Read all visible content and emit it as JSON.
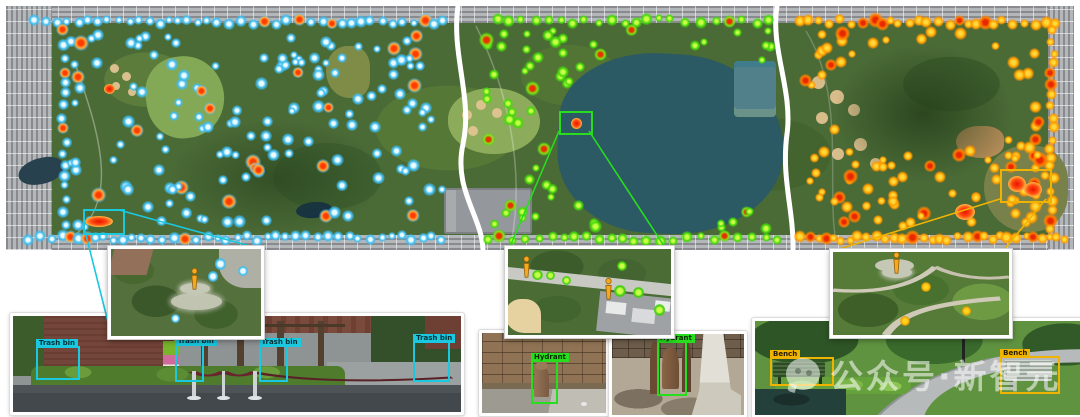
{
  "watermark": {
    "text": "公众号·新智元"
  },
  "object_classes": [
    {
      "name": "Trash bin",
      "color": "#1ac8e0"
    },
    {
      "name": "Hydrant",
      "color": "#28dd1e"
    },
    {
      "name": "Bench",
      "color": "#f0b400"
    }
  ],
  "heatmap": {
    "seed": 1337,
    "zones": [
      {
        "name": "trash-bin-zone",
        "core": "#ecfbff",
        "mid": "#3fbdf0",
        "glow": "rgba(64,189,240,0.55)",
        "hot_core": "#ff3c00",
        "hot_mid": "#ffab40",
        "hot_glow": "rgba(90,190,240,0.5)",
        "hot_ratio": 0.11,
        "rows": [
          {
            "x0": 28,
            "x1": 441,
            "y": 16,
            "step": 11
          },
          {
            "x0": 22,
            "x1": 441,
            "y": 232,
            "step": 10
          }
        ],
        "cols": [
          {
            "x": 58,
            "y0": 24,
            "y1": 228,
            "step": 12
          }
        ],
        "interior": {
          "count": 150,
          "x0": 64,
          "x1": 436,
          "y0": 24,
          "y1": 224,
          "avoid": []
        }
      },
      {
        "name": "hydrant-zone",
        "core": "#c8ff46",
        "mid": "#46d80a",
        "glow": "rgba(70,216,10,0.5)",
        "hot_core": "#e83000",
        "hot_mid": "#8ae018",
        "hot_glow": "rgba(70,216,10,0.5)",
        "hot_ratio": 0.09,
        "rows": [
          {
            "x0": 492,
            "x1": 772,
            "y": 15,
            "step": 13
          },
          {
            "x0": 482,
            "x1": 772,
            "y": 233,
            "step": 12
          }
        ],
        "cols": [],
        "interior": {
          "count": 62,
          "x0": 480,
          "x1": 770,
          "y0": 24,
          "y1": 224,
          "avoid": [
            {
              "cx": 659,
              "cy": 132,
              "rx": 114,
              "ry": 92
            }
          ]
        }
      },
      {
        "name": "bench-zone",
        "core": "#ffd83a",
        "mid": "#ffa400",
        "glow": "rgba(255,140,0,0.5)",
        "hot_core": "#e82800",
        "hot_mid": "#ff7a00",
        "hot_glow": "rgba(255,140,0,0.5)",
        "hot_ratio": 0.16,
        "rows": [
          {
            "x0": 794,
            "x1": 1058,
            "y": 16,
            "step": 10
          },
          {
            "x0": 794,
            "x1": 1060,
            "y": 232,
            "step": 9
          }
        ],
        "cols": [
          {
            "x": 1046,
            "y0": 24,
            "y1": 228,
            "step": 11
          },
          {
            "x": 1028,
            "y0": 120,
            "y1": 222,
            "step": 14
          }
        ],
        "interior": {
          "count": 88,
          "x0": 796,
          "x1": 1040,
          "y0": 26,
          "y1": 222,
          "avoid": [
            {
              "cx": 916,
              "cy": 92,
              "rx": 84,
              "ry": 58
            }
          ]
        }
      }
    ],
    "hotspots": [
      {
        "x": 79,
        "y": 210,
        "w": 28,
        "h": 11
      },
      {
        "x": 98,
        "y": 78,
        "w": 11,
        "h": 10
      },
      {
        "x": 565,
        "y": 112,
        "w": 11,
        "h": 11
      },
      {
        "x": 1002,
        "y": 170,
        "w": 18,
        "h": 16
      },
      {
        "x": 1018,
        "y": 176,
        "w": 18,
        "h": 15
      },
      {
        "x": 949,
        "y": 198,
        "w": 20,
        "h": 16
      }
    ]
  },
  "annotations": {
    "rects": [
      {
        "x": 77,
        "y": 203,
        "w": 38,
        "h": 22,
        "color": "#1ac8e0"
      },
      {
        "x": 553,
        "y": 105,
        "w": 30,
        "h": 20,
        "color": "#28dd1e"
      },
      {
        "x": 994,
        "y": 163,
        "w": 48,
        "h": 30,
        "color": "#f0b400"
      }
    ],
    "lines": [
      {
        "x1": 119,
        "y1": 210,
        "x2": 257,
        "y2": 248,
        "color": "#1ac8e0"
      },
      {
        "x1": 85,
        "y1": 231,
        "x2": 110,
        "y2": 330,
        "color": "#1ac8e0"
      },
      {
        "x1": 559,
        "y1": 131,
        "x2": 509,
        "y2": 249,
        "color": "#28dd1e"
      },
      {
        "x1": 589,
        "y1": 131,
        "x2": 666,
        "y2": 249,
        "color": "#28dd1e"
      },
      {
        "x1": 1000,
        "y1": 199,
        "x2": 833,
        "y2": 251,
        "color": "#f0b400"
      },
      {
        "x1": 1046,
        "y1": 199,
        "x2": 1003,
        "y2": 251,
        "color": "#f0b400"
      }
    ]
  },
  "insets": [
    {
      "name": "trash-bin-closeup",
      "markers": [
        {
          "x": 52,
          "y": 22,
          "pad": true
        }
      ],
      "dots": [
        {
          "x": 73,
          "y": 17
        },
        {
          "x": 68,
          "y": 32
        },
        {
          "x": 43,
          "y": 80
        },
        {
          "x": 88,
          "y": 25
        }
      ],
      "dot_style": {
        "core": "#ecfbff",
        "mid": "#3fbdf0",
        "glow": "rgba(64,189,240,0.6)"
      }
    },
    {
      "name": "hydrant-closeup",
      "markers": [
        {
          "x": 8,
          "y": 8,
          "pad": false
        },
        {
          "x": 58,
          "y": 34,
          "pad": false
        }
      ],
      "dots": [
        {
          "x": 18,
          "y": 30
        },
        {
          "x": 26,
          "y": 31
        },
        {
          "x": 36,
          "y": 37
        },
        {
          "x": 69,
          "y": 49
        },
        {
          "x": 80,
          "y": 51
        },
        {
          "x": 93,
          "y": 71
        },
        {
          "x": 70,
          "y": 20
        }
      ],
      "dot_style": {
        "core": "#c8ff46",
        "mid": "#3ecc0a",
        "glow": "rgba(62,204,10,0.55)"
      }
    },
    {
      "name": "bench-closeup",
      "markers": [
        {
          "x": 33,
          "y": 0,
          "pad": true
        }
      ],
      "dots": [
        {
          "x": 53,
          "y": 42
        },
        {
          "x": 76,
          "y": 71
        },
        {
          "x": 41,
          "y": 83
        }
      ],
      "dot_style": {
        "core": "#ffd21e",
        "mid": "#f0a800",
        "glow": "rgba(200,140,0,0.45)"
      }
    }
  ],
  "photos": [
    {
      "name": "trash-bin-street-photo",
      "box_color": "#1ac8e0",
      "tag_text": "#003238",
      "boxes": [
        {
          "label": "Trash bin",
          "x": 5.1,
          "y": 31,
          "w": 8.9,
          "h": 32
        },
        {
          "label": "Trash bin",
          "x": 36.1,
          "y": 29,
          "w": 5.6,
          "h": 35.5
        },
        {
          "label": "Trash bin",
          "x": 54.8,
          "y": 30,
          "w": 5.6,
          "h": 34.5
        },
        {
          "label": "Trash bin",
          "x": 89.3,
          "y": 26,
          "w": 7.4,
          "h": 38.5
        }
      ]
    },
    {
      "name": "hydrant-photo-1",
      "box_color": "#28dd1e",
      "tag_text": "#0a2800",
      "boxes": [
        {
          "label": "Hydrant",
          "x": 39.5,
          "y": 33.8,
          "w": 18.5,
          "h": 50
        }
      ]
    },
    {
      "name": "hydrant-photo-2",
      "box_color": "#28dd1e",
      "tag_text": "#0a2800",
      "boxes": [
        {
          "label": "Hydrant",
          "x": 34,
          "y": 9,
          "w": 20,
          "h": 63
        }
      ]
    },
    {
      "name": "bench-photo",
      "box_color": "#f0b400",
      "tag_text": "#231a00",
      "boxes": [
        {
          "label": "Bench",
          "x": 4.6,
          "y": 38,
          "w": 18.4,
          "h": 27
        },
        {
          "label": "Bench",
          "x": 75.2,
          "y": 37,
          "w": 17.2,
          "h": 36
        }
      ]
    }
  ]
}
